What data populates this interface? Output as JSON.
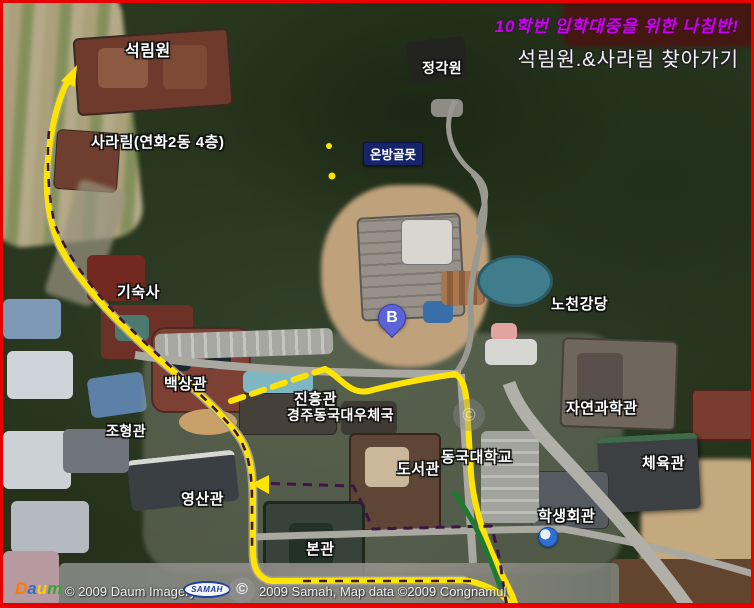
{
  "title_overlay": {
    "line1": "10학번 입학대중을 위한 나침반!",
    "line2": "석림원.&사라림 찾아가기",
    "line1_color": "#c800ee"
  },
  "marker_b": {
    "label": "B",
    "color": "#5b63d8"
  },
  "labels": {
    "seokrimwon": "석림원",
    "sararim": "사라림(연화2동 4층)",
    "jeonggagwon": "정각원",
    "onbanggolmot": "온방골못",
    "gisuksa": "기숙사",
    "nocheongangdang": "노천강당",
    "baeksanggwan": "백상관",
    "jinheunggwan": "진흥관",
    "postoffice": "경주동국대우체국",
    "johyeonggwan": "조형관",
    "jayeongwahakgwan": "자연과학관",
    "donggukuniv": "동국대학교",
    "doseogwan": "도서관",
    "cheyukgwan": "체육관",
    "haksaenghoegwan": "학생회관",
    "yeongsangwan": "영산관",
    "bongwan": "본관"
  },
  "attribution": {
    "daum_d": "D",
    "daum_a": "a",
    "daum_u": "u",
    "daum_m": "m",
    "left_text": "© 2009 Daum Imagery",
    "samah_logo": "SAMAH",
    "right_text": "2009 Samah, Map data ©2009 Congnamul",
    "copyright_symbol": "©"
  },
  "route_colors": {
    "main": "#ffe400",
    "dash": "#3d1446",
    "green": "#1e7a2e",
    "road": "#a9a9a1"
  }
}
